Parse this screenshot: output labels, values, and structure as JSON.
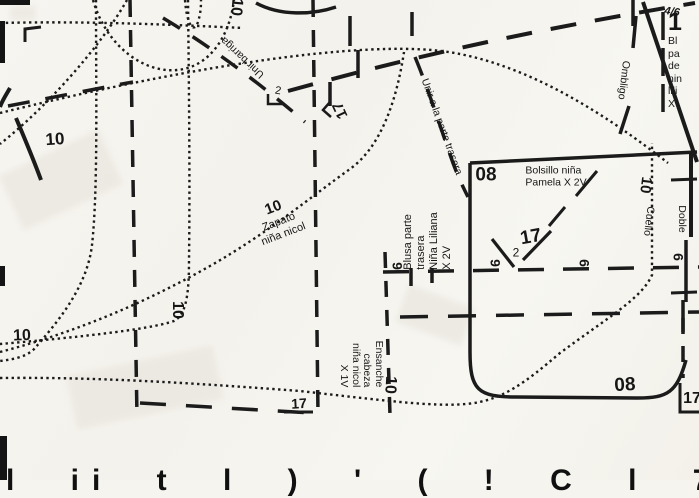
{
  "marks": {
    "unir_barriga": "Unir barriga",
    "unir_parte_trasera": "Unir a la parte trasera",
    "ombligo": "Ombligo",
    "fraction": "4/6",
    "mark2": "2",
    "mark3_17": "17",
    "top_10": "10",
    "midleft_10": "10",
    "bottomleft_10": "10",
    "box_10": "10",
    "bottom_17": "17",
    "corner_17": "17",
    "bottom_fragments": "l ii t l ) ' ( ! C l 7 l ll"
  },
  "right_edge_block": {
    "number": "1",
    "lines": [
      "Bl",
      "pa",
      "de",
      "nin",
      "lili",
      "X"
    ]
  },
  "bolsillo": {
    "code_top": "08",
    "name_line1": "Bolsillo niña",
    "name_line2": "Pamela X 2V",
    "pleat_size": "17",
    "pleat_number": "2",
    "code_bottom": "08",
    "notch1": "9",
    "notch2": "9",
    "notch3": "6",
    "notch4": "6"
  },
  "cuello": {
    "size": "10",
    "label": "Cuello"
  },
  "doble_label": "Doble",
  "zapato": {
    "size": "10",
    "line1": "Zapato",
    "line2": "niña nicol"
  },
  "blusa_trasera": {
    "lines": [
      "Blusa parte",
      "trasera",
      "Niña Liliana",
      "X 2V"
    ]
  },
  "ensanche": {
    "size": "10",
    "lines": [
      "Ensanche",
      "cabeza",
      "niña nicol",
      "X 1V"
    ]
  },
  "ink_color": "#1b1b1b"
}
